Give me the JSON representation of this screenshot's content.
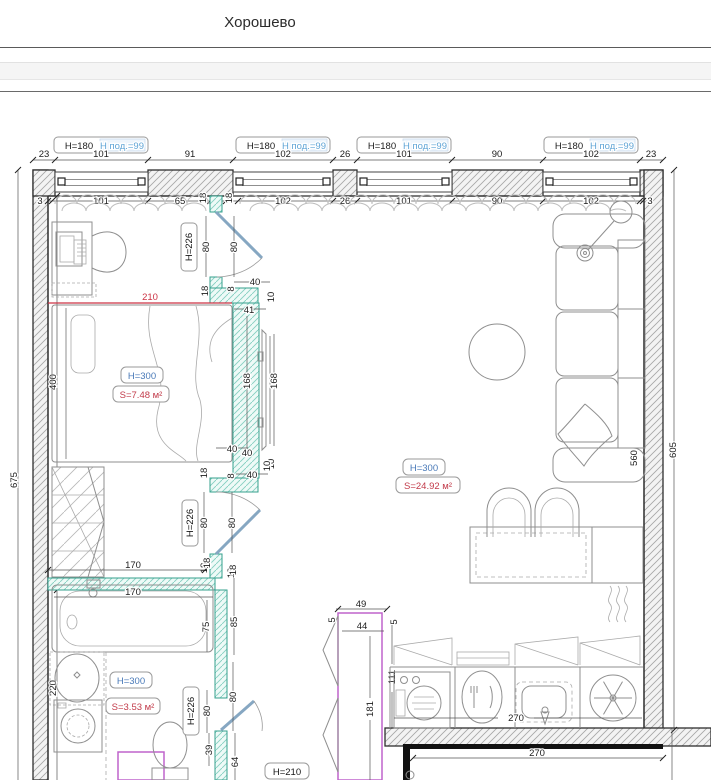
{
  "header": {
    "title": "Хорошево"
  },
  "plan": {
    "win": {
      "h": "H=180",
      "pod": "Н под.=99"
    },
    "row1": [
      "23",
      "101",
      "91",
      "102",
      "26",
      "101",
      "90",
      "102",
      "23"
    ],
    "row2": [
      "3",
      "101",
      "65",
      "18",
      "18",
      "102",
      "26",
      "101",
      "90",
      "102",
      "3"
    ],
    "v675": "675",
    "v400": "400",
    "v220": "220",
    "v560": "560",
    "v605": "605",
    "red210": "210",
    "bedroom": {
      "h": "H=300",
      "s": "S=7.48 м²"
    },
    "living": {
      "h": "H=300",
      "s": "S=24.92 м²"
    },
    "bath": {
      "h": "H=300",
      "s": "S=3.53 м²",
      "wall170": "170",
      "w18a": "18",
      "w18b": "18",
      "tub170": "170",
      "tub75": "75",
      "v85": "85"
    },
    "wc": {
      "h226": "H=226",
      "p80a": "80",
      "p80b": "80",
      "v39": "39",
      "v64": "64"
    },
    "hall": {
      "h210": "H=210"
    },
    "door1": {
      "h226": "H=226",
      "p80a": "80",
      "p80b": "80",
      "v18": "18",
      "v8": "8",
      "h40": "40"
    },
    "tv": {
      "h41": "41",
      "v10a": "10",
      "v168a": "168",
      "v168b": "168",
      "v10b": "10",
      "h40": "40"
    },
    "door2": {
      "h40a": "40",
      "v18a": "18",
      "v8": "8",
      "h40b": "40",
      "v10": "10",
      "h226": "H=226",
      "p80a": "80",
      "p80b": "80",
      "v18b": "18",
      "v18c": "18"
    },
    "ward": {
      "h49": "49",
      "v5a": "5",
      "h44": "44",
      "v5b": "5",
      "v111": "111",
      "v181": "181"
    },
    "kitchen": {
      "h270a": "270",
      "h270b": "270"
    }
  }
}
